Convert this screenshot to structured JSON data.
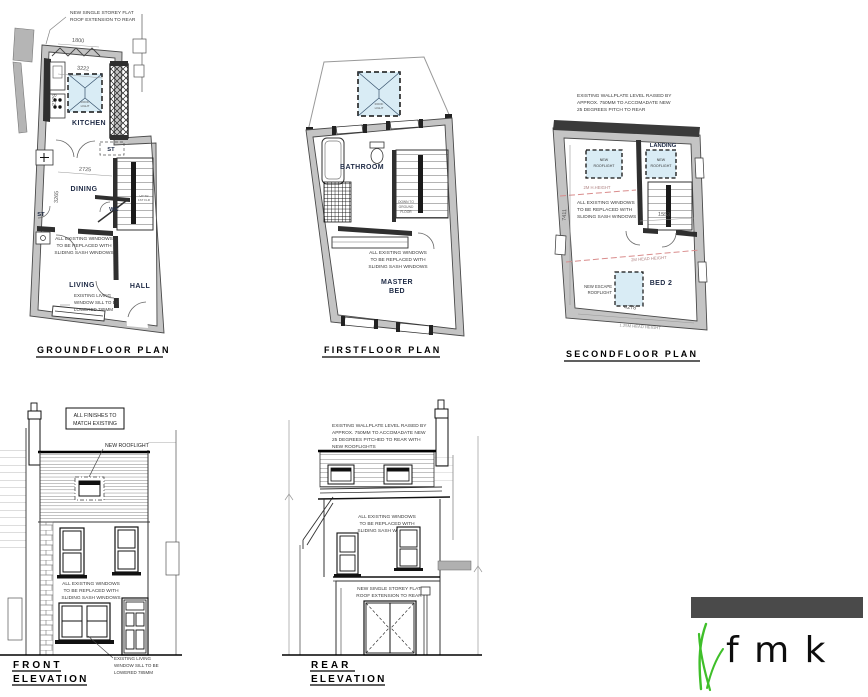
{
  "ground": {
    "title": "GROUNDFLOOR PLAN",
    "ext_note": [
      "NEW SINGLE STOREY FLAT",
      "ROOF EXTENSION TO REAR"
    ],
    "windows_note": [
      "ALL EXISTING WINDOWS",
      "TO BE REPLACED WITH",
      "SLIDING SASH WINDOWS"
    ],
    "sill_note": [
      "EXISTING LIVING",
      "WINDOW SILL TO BE",
      "LOWERED 785MM"
    ],
    "labels": {
      "kitchen": "KITCHEN",
      "dining": "DINING",
      "living": "LIVING",
      "hall": "HALL",
      "wc": "WC",
      "st_upper": "ST",
      "st_lower": "ST"
    },
    "dims": {
      "d1": "1800",
      "d2": "3222",
      "d3": "2178",
      "d4": "2725",
      "d5": "3265"
    },
    "rooflight": [
      "ROOF",
      "LIGHT"
    ],
    "stair": [
      "UP TO",
      "1ST FLR"
    ]
  },
  "first": {
    "title": "FIRSTFLOOR PLAN",
    "labels": {
      "bathroom": "BATHROOM",
      "master1": "MASTER",
      "master2": "BED"
    },
    "windows_note": [
      "ALL EXISTING WINDOWS",
      "TO BE REPLACED WITH",
      "SLIDING SASH WINDOWS"
    ],
    "stair": [
      "DOWN TO",
      "GROUND",
      "FLOOR"
    ],
    "rooflight": [
      "ROOF",
      "LIGHT"
    ]
  },
  "second": {
    "title": "SECONDFLOOR PLAN",
    "wallplate_note": [
      "EXISTING WALLPLATE LEVEL RAISED BY",
      "APPROX. 750MM TO ACCOMADATE NEW",
      "25 DEGREES PITCH TO REAR"
    ],
    "labels": {
      "landing": "LANDING",
      "bed2": "BED 2"
    },
    "rooflight": [
      "NEW",
      "ROOFLIGHT"
    ],
    "escape_rooflight": [
      "NEW ESCAPE",
      "ROOFLIGHT"
    ],
    "windows_note": [
      "ALL EXISTING WINDOWS",
      "TO BE REPLACED WITH",
      "SLIDING SASH WINDOWS"
    ],
    "heights": {
      "h1": "2M H.HEIGHT",
      "h2": "2M HEAD HEIGHT",
      "h3": "1.25M HEAD HEIGHT"
    },
    "dims": {
      "d1": "7411",
      "d2": "1553",
      "d3": "4278"
    }
  },
  "front": {
    "title1": "FRONT",
    "title2": "ELEVATION",
    "finishes_note": [
      "ALL FINISHES TO",
      "MATCH EXISTING"
    ],
    "rooflight_note": "NEW ROOFLIGHT",
    "windows_note": [
      "ALL EXISTING WINDOWS",
      "TO BE REPLACED WITH",
      "SLIDING SASH WINDOWS"
    ],
    "sill_note": [
      "EXISTING LIVING",
      "WINDOW SILL TO BE",
      "LOWERED 785MM"
    ]
  },
  "rear": {
    "title1": "REAR",
    "title2": "ELEVATION",
    "wallplate_note": [
      "EXISTING WALLPLATE LEVEL RAISED BY",
      "APPROX. 750MM TO ACCOMADATE NEW",
      "25 DEGREES PITCHED TO REAR WITH",
      "NEW ROOFLIGHTS"
    ],
    "windows_note": [
      "ALL EXISTING WINDOWS",
      "TO BE REPLACED WITH",
      "SLIDING SASH WINDOWS"
    ],
    "extension_note": [
      "NEW SINGLE STOREY FLAT",
      "ROOF EXTENSION TO REAR"
    ]
  },
  "logo": {
    "text": "f m k"
  },
  "colors": {
    "rooflight": "#d9ecf5",
    "wall": "#c4c4c4",
    "dark_wall": "#2f2f2f",
    "red_line": "#d98c8c",
    "logo_bar": "#4a4a4a",
    "grass": "#3fbf2a"
  }
}
